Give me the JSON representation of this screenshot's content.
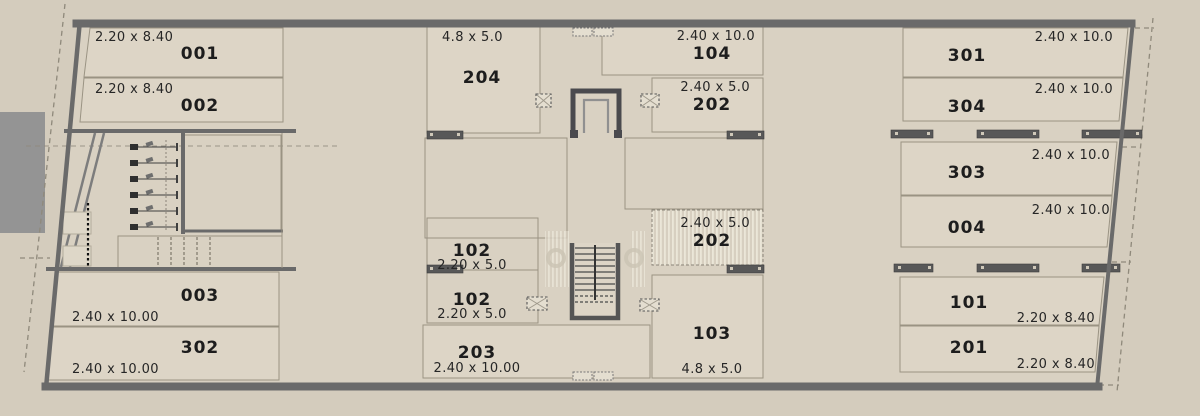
{
  "plan": {
    "type": "storage-units-floor-plan",
    "colors": {
      "background": "#d4ccbd",
      "plan_fill": "#d9d1c2",
      "room_fill": "#ddd5c6",
      "wall": "#6a6a6a",
      "hatch_light": "#ebe6d8",
      "hatch_dark": "#d7cfc0",
      "neighbor_block": "#949494",
      "text": "#1d1d1d"
    },
    "rooms": {
      "r001": {
        "number": "001",
        "dims": "2.20 x 8.40"
      },
      "r002": {
        "number": "002",
        "dims": "2.20 x 8.40"
      },
      "r003": {
        "number": "003",
        "dims": "2.40 x 10.00"
      },
      "r302": {
        "number": "302",
        "dims": "2.40 x 10.00"
      },
      "r204": {
        "number": "204",
        "dims": "4.8 x 5.0"
      },
      "r102a": {
        "number": "102",
        "dims": "2.20 x 5.0"
      },
      "r102b": {
        "number": "102",
        "dims": "2.20 x 5.0"
      },
      "r203": {
        "number": "203",
        "dims": "2.40 x 10.00"
      },
      "r104": {
        "number": "104",
        "dims": "2.40 x 10.0"
      },
      "r202a": {
        "number": "202",
        "dims": "2.40 x 5.0"
      },
      "r202b": {
        "number": "202",
        "dims": "2.40 x 5.0"
      },
      "r103": {
        "number": "103",
        "dims": "4.8 x 5.0"
      },
      "r301": {
        "number": "301",
        "dims": "2.40 x 10.0"
      },
      "r304": {
        "number": "304",
        "dims": "2.40 x 10.0"
      },
      "r303": {
        "number": "303",
        "dims": "2.40 x 10.0"
      },
      "r004": {
        "number": "004",
        "dims": "2.40 x 10.0"
      },
      "r101": {
        "number": "101",
        "dims": "2.20 x 8.40"
      },
      "r201": {
        "number": "201",
        "dims": "2.20 x 8.40"
      }
    }
  }
}
